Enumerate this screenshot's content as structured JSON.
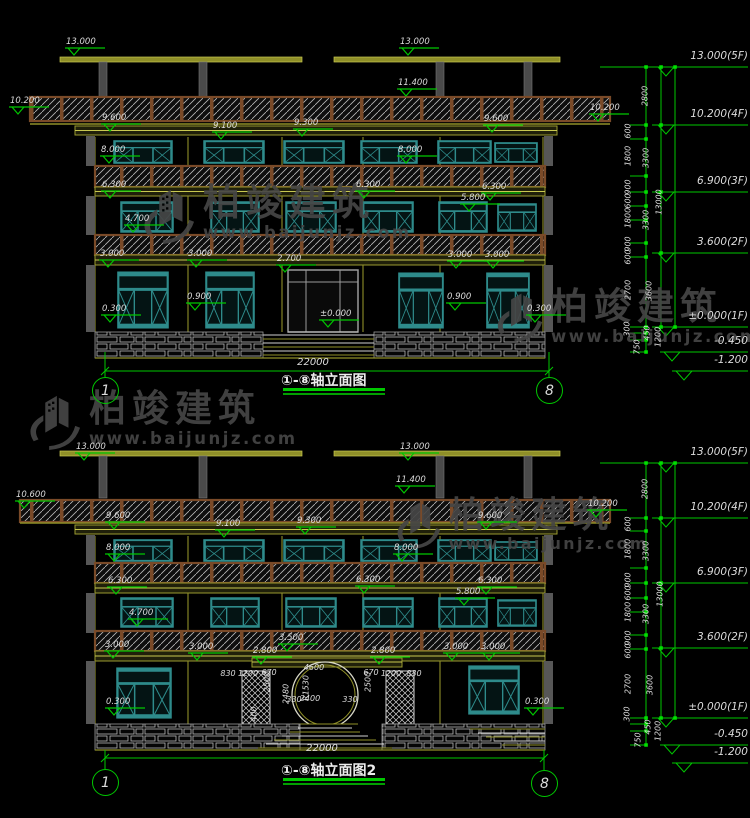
{
  "watermark": {
    "brand": "柏竣建筑",
    "url": "www.baijunjz.com"
  },
  "colors": {
    "background": "#000000",
    "dimension_green": "#00C800",
    "text_white": "#DCDCDC",
    "structure_yellow": "#C8C850",
    "window_teal": "#2E8B8B",
    "hatch_brown": "#7A4A28",
    "watermark_gray": "#464646"
  },
  "drawings": [
    {
      "title": "①-⑧轴立面图",
      "axis_start": "1",
      "axis_end": "8",
      "overall_width_dim": "22000",
      "elev_labels": [
        [
          64,
          38,
          "13.000"
        ],
        [
          398,
          38,
          "13.000"
        ],
        [
          396,
          79,
          "11.400"
        ],
        [
          8,
          97,
          "10.200"
        ],
        [
          588,
          104,
          "10.200"
        ],
        [
          100,
          114,
          "9.600"
        ],
        [
          482,
          115,
          "9.600"
        ],
        [
          211,
          122,
          "9.100"
        ],
        [
          292,
          119,
          "9.300"
        ],
        [
          99,
          146,
          "8.000"
        ],
        [
          396,
          146,
          "8.000"
        ],
        [
          100,
          181,
          "6.300"
        ],
        [
          354,
          181,
          "6.300"
        ],
        [
          480,
          183,
          "6.300"
        ],
        [
          459,
          194,
          "5.800"
        ],
        [
          123,
          215,
          "4.700"
        ],
        [
          98,
          250,
          "3.000"
        ],
        [
          186,
          250,
          "3.000"
        ],
        [
          275,
          255,
          "2.700"
        ],
        [
          446,
          251,
          "3.000"
        ],
        [
          483,
          251,
          "3.000"
        ],
        [
          185,
          293,
          "0.900"
        ],
        [
          445,
          293,
          "0.900"
        ],
        [
          100,
          305,
          "0.300"
        ],
        [
          525,
          305,
          "0.300"
        ],
        [
          318,
          310,
          "±0.000"
        ]
      ],
      "dim_labels": [],
      "dim_labels_rot": []
    },
    {
      "title": "①-⑧轴立面图2",
      "axis_start": "1",
      "axis_end": "8",
      "overall_width_dim": "22000",
      "elev_labels": [
        [
          74,
          443,
          "13.000"
        ],
        [
          398,
          443,
          "13.000"
        ],
        [
          394,
          476,
          "11.400"
        ],
        [
          14,
          491,
          "10.600"
        ],
        [
          586,
          500,
          "10.200"
        ],
        [
          104,
          512,
          "9.600"
        ],
        [
          476,
          512,
          "9.600"
        ],
        [
          214,
          520,
          "9.100"
        ],
        [
          295,
          517,
          "9.300"
        ],
        [
          104,
          544,
          "8.000"
        ],
        [
          392,
          544,
          "8.000"
        ],
        [
          106,
          577,
          "6.300"
        ],
        [
          354,
          576,
          "6.300"
        ],
        [
          476,
          577,
          "6.300"
        ],
        [
          454,
          588,
          "5.800"
        ],
        [
          127,
          609,
          "4.700"
        ],
        [
          103,
          641,
          "3.000"
        ],
        [
          187,
          643,
          "3.000"
        ],
        [
          251,
          647,
          "2.800"
        ],
        [
          277,
          634,
          "3.500"
        ],
        [
          369,
          647,
          "2.800"
        ],
        [
          442,
          643,
          "3.000"
        ],
        [
          479,
          643,
          "3.000"
        ],
        [
          104,
          698,
          "0.300"
        ],
        [
          523,
          698,
          "0.300"
        ]
      ],
      "dim_labels": [
        [
          228,
          669,
          "830"
        ],
        [
          248,
          669,
          "1200"
        ],
        [
          269,
          668,
          "670"
        ],
        [
          314,
          663,
          "4600"
        ],
        [
          371,
          668,
          "670"
        ],
        [
          391,
          669,
          "1200"
        ],
        [
          414,
          669,
          "830"
        ],
        [
          294,
          695,
          "330"
        ],
        [
          310,
          694,
          "2400"
        ],
        [
          350,
          695,
          "330"
        ]
      ],
      "dim_labels_rot": [
        [
          306,
          688,
          "R1530"
        ],
        [
          286,
          694,
          "2480"
        ],
        [
          267,
          682,
          "2500"
        ],
        [
          368,
          682,
          "2500"
        ],
        [
          254,
          714,
          "400"
        ]
      ]
    }
  ],
  "scales": [
    {
      "levels": [
        [
          67,
          "13.000(5F)"
        ],
        [
          125,
          "10.200(4F)"
        ],
        [
          192,
          "6.900(3F)"
        ],
        [
          253,
          "3.600(2F)"
        ],
        [
          327,
          "±0.000(1F)"
        ],
        [
          352,
          "-0.450"
        ],
        [
          371,
          "-1.200"
        ]
      ],
      "chain": [
        [
          645,
          96,
          "2800"
        ],
        [
          628,
          131,
          "600"
        ],
        [
          628,
          156,
          "1800"
        ],
        [
          646,
          158,
          "3300"
        ],
        [
          628,
          187,
          "900"
        ],
        [
          628,
          201,
          "600"
        ],
        [
          659,
          202,
          "13000"
        ],
        [
          628,
          218,
          "1800"
        ],
        [
          646,
          220,
          "3300"
        ],
        [
          628,
          244,
          "900"
        ],
        [
          628,
          257,
          "600"
        ],
        [
          628,
          290,
          "2700"
        ],
        [
          649,
          291,
          "3600"
        ],
        [
          627,
          329,
          "300"
        ],
        [
          647,
          333,
          "450"
        ],
        [
          658,
          337,
          "1200"
        ],
        [
          637,
          347,
          "750"
        ]
      ]
    },
    {
      "levels": [
        [
          463,
          "13.000(5F)"
        ],
        [
          518,
          "10.200(4F)"
        ],
        [
          583,
          "6.900(3F)"
        ],
        [
          648,
          "3.600(2F)"
        ],
        [
          718,
          "±0.000(1F)"
        ],
        [
          745,
          "-0.450"
        ],
        [
          763,
          "-1.200"
        ]
      ],
      "chain": [
        [
          645,
          489,
          "2800"
        ],
        [
          628,
          524,
          "600"
        ],
        [
          628,
          549,
          "1800"
        ],
        [
          646,
          551,
          "3300"
        ],
        [
          628,
          580,
          "900"
        ],
        [
          628,
          593,
          "600"
        ],
        [
          660,
          594,
          "13000"
        ],
        [
          628,
          612,
          "1800"
        ],
        [
          646,
          614,
          "3300"
        ],
        [
          628,
          638,
          "900"
        ],
        [
          628,
          651,
          "600"
        ],
        [
          628,
          684,
          "2700"
        ],
        [
          650,
          685,
          "3600"
        ],
        [
          627,
          714,
          "300"
        ],
        [
          648,
          727,
          "450"
        ],
        [
          658,
          731,
          "1200"
        ],
        [
          638,
          740,
          "750"
        ]
      ]
    }
  ]
}
